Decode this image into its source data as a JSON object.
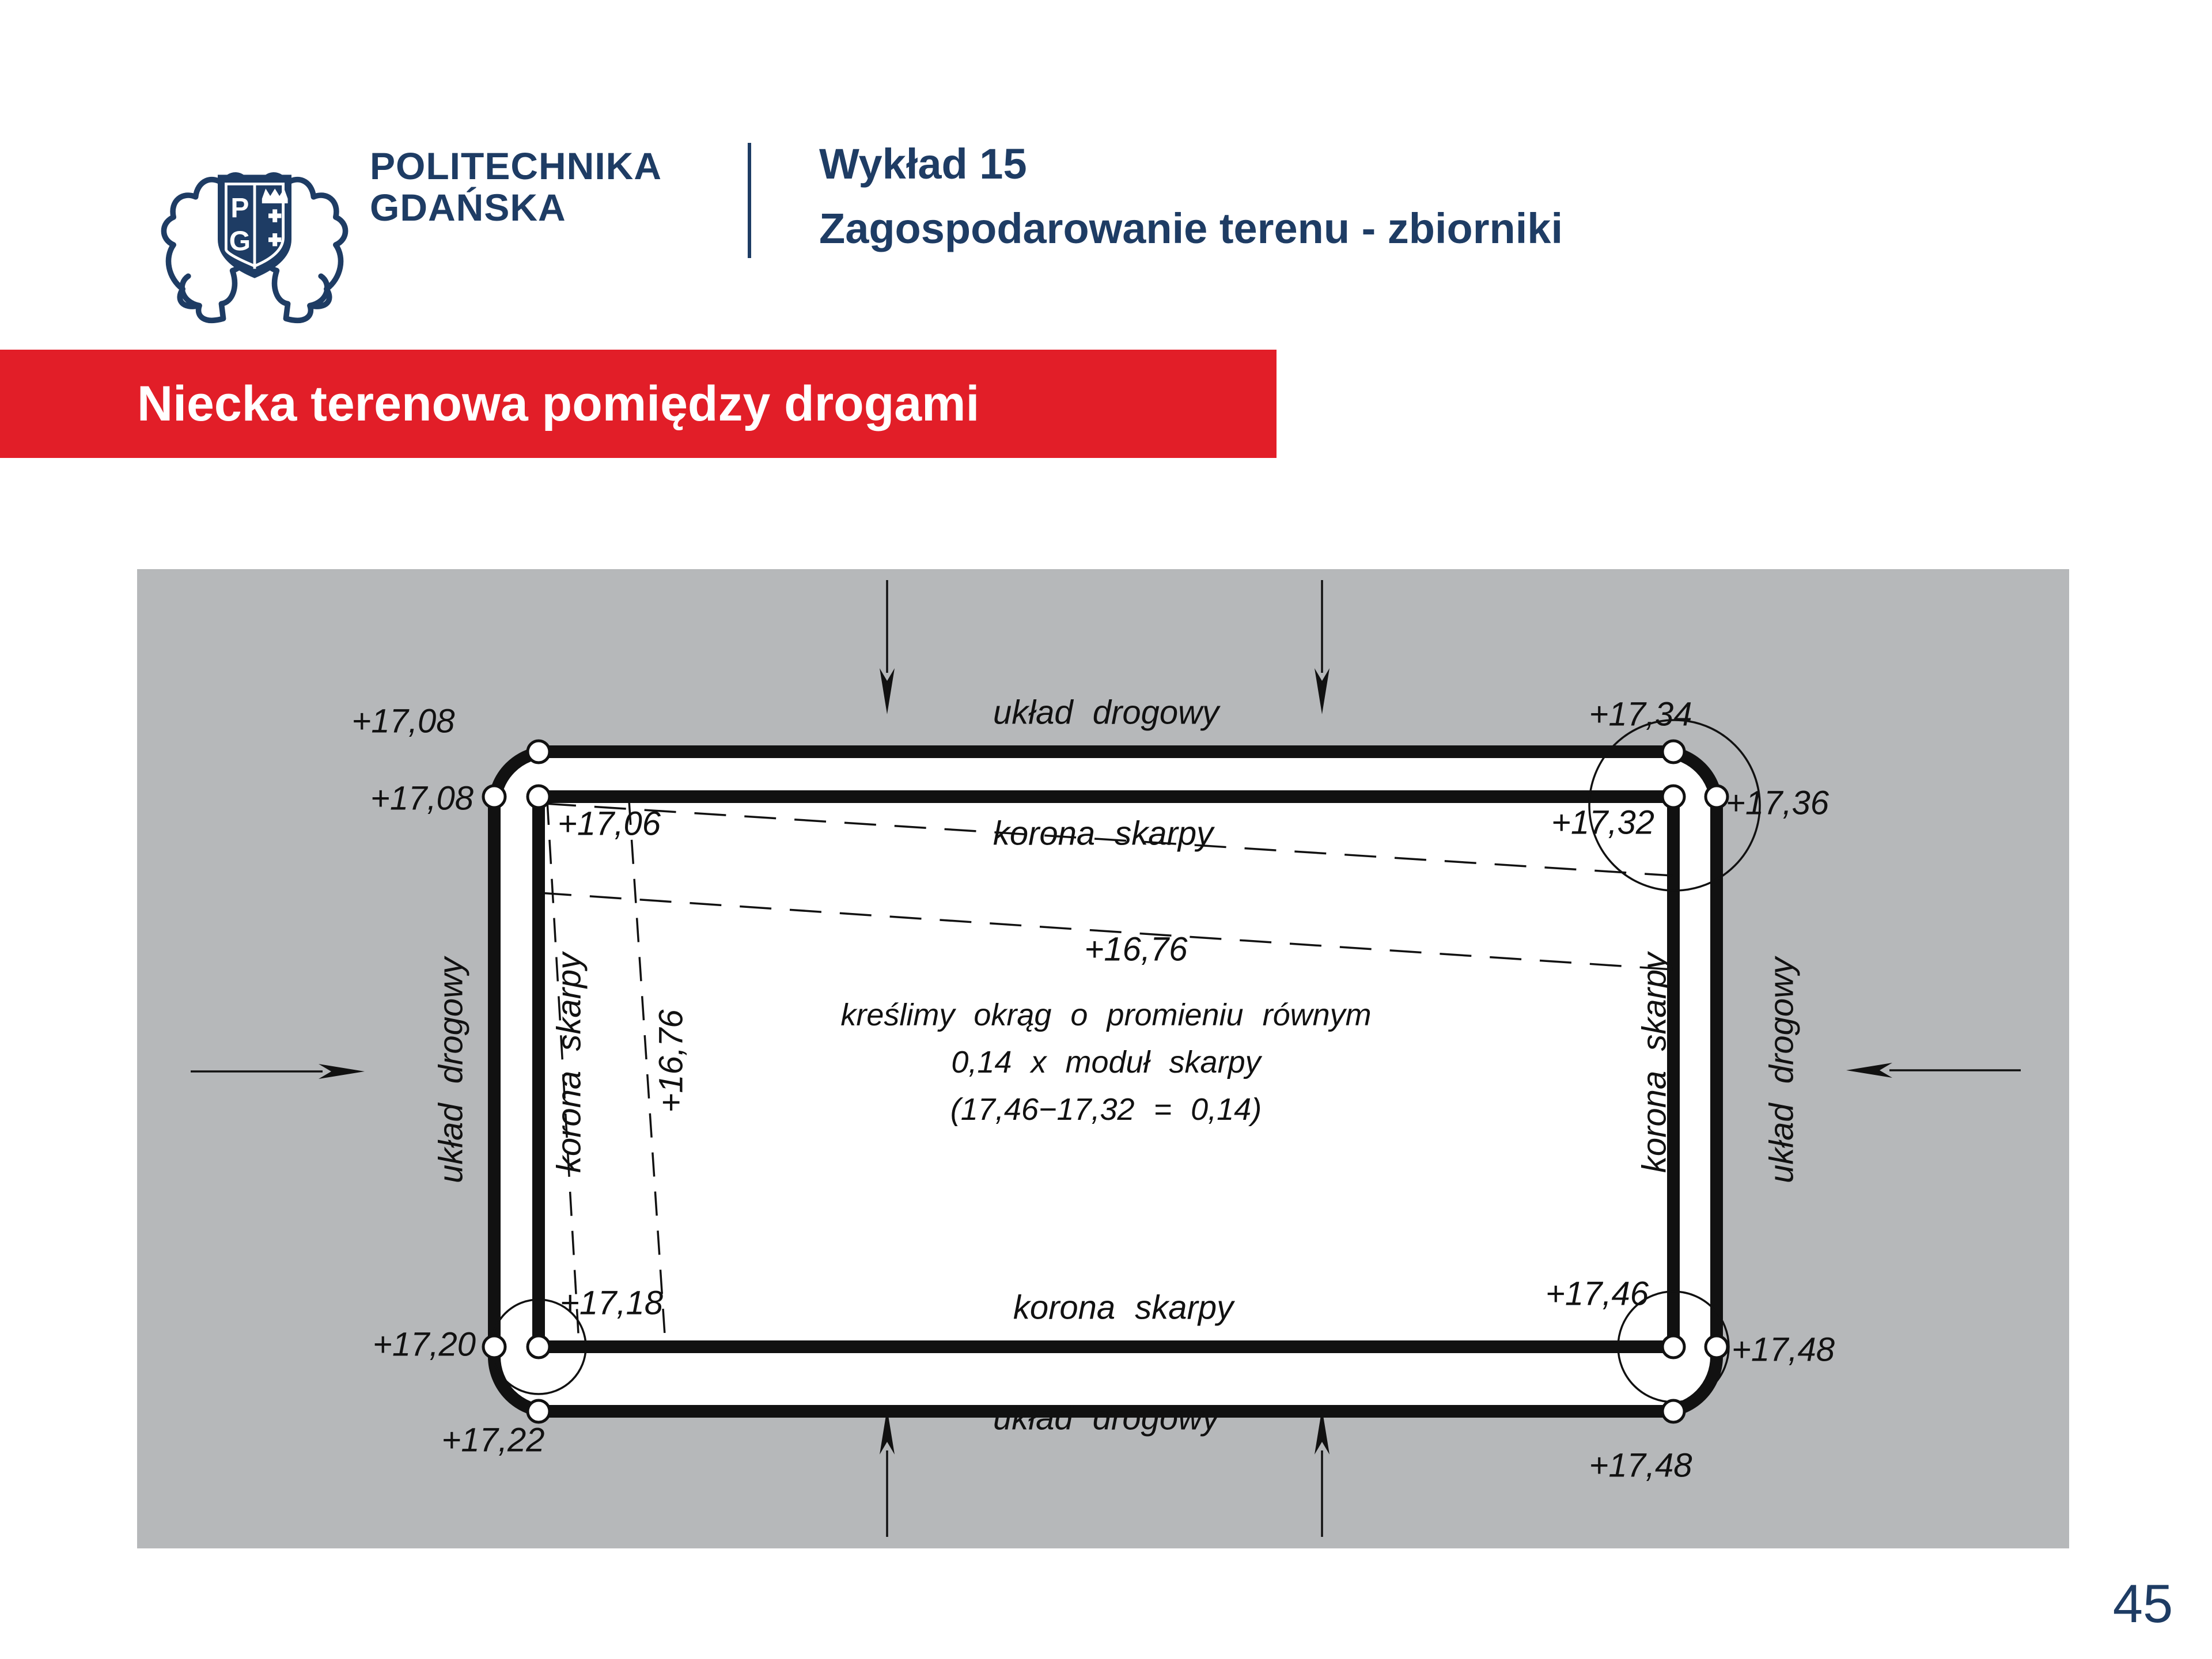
{
  "header": {
    "university_line1": "POLITECHNIKA",
    "university_line2": "GDAŃSKA",
    "monogram_p": "P",
    "monogram_g": "G",
    "lecture": "Wykład 15",
    "topic": "Zagospodarowanie terenu - zbiorniki"
  },
  "banner": {
    "title": "Niecka terenowa pomiędzy drogami"
  },
  "footer": {
    "page_number": "45"
  },
  "colors": {
    "navy": "#1e3c64",
    "banner_red": "#e21e28",
    "panel_gray": "#b6b8ba",
    "ink": "#111111"
  },
  "diagram": {
    "road_label_top": "układ drogowy",
    "road_label_bottom": "układ drogowy",
    "road_label_left": "układ drogowy",
    "road_label_right": "układ drogowy",
    "crest_label_top": "korona skarpy",
    "crest_label_bottom": "korona skarpy",
    "crest_label_left": "korona skarpy",
    "crest_label_right": "korona skarpy",
    "elevations": {
      "top_left_outer_top": "+17,08",
      "top_left_outer_side": "+17,08",
      "top_left_inner": "+17,06",
      "top_right_outer_top": "+17,34",
      "top_right_outer_side": "+17,36",
      "top_right_inner": "+17,32",
      "bottom_left_outer_side": "+17,20",
      "bottom_left_outer_bottom": "+17,22",
      "bottom_left_inner": "+17,18",
      "bottom_right_inner": "+17,46",
      "bottom_right_outer_side": "+17,48",
      "bottom_right_outer_bottom": "+17,48",
      "basin_contour": "+16,76",
      "basin_contour_left": "+16,76"
    },
    "note_line1": "kreślimy okrąg o promieniu równym",
    "note_line2": "0,14 x moduł skarpy",
    "note_line3": "(17,46−17,32 = 0,14)"
  }
}
